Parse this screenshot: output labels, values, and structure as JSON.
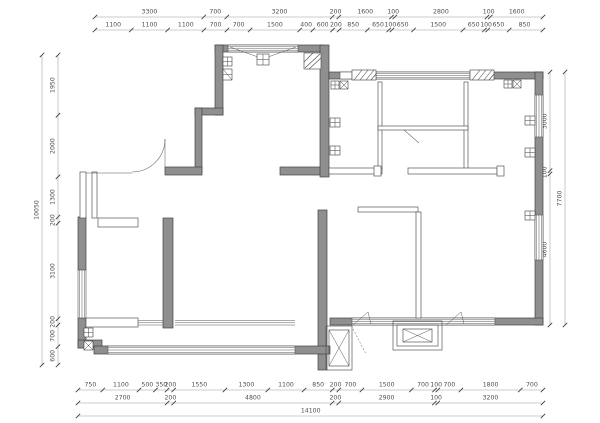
{
  "drawing": {
    "type": "floor-plan",
    "units": "mm",
    "colors": {
      "wall_fill": "#8f8f8f",
      "wall_stroke": "#434343",
      "dim_line": "#9a9a9a",
      "dim_text": "#4f4f4f",
      "background": "#ffffff"
    }
  },
  "dims": {
    "top_row1": [
      "3300",
      "700",
      "3200",
      "200",
      "1600",
      "100",
      "2800",
      "100",
      "1600"
    ],
    "top_row2": [
      "1100",
      "1100",
      "1100",
      "700",
      "700",
      "1500",
      "400",
      "600",
      "200",
      "850",
      "650",
      "100",
      "650",
      "1500",
      "650",
      "100",
      "650",
      "850"
    ],
    "bottom_row1": [
      "750",
      "1100",
      "500",
      "350",
      "200",
      "1550",
      "1300",
      "1100",
      "850",
      "200",
      "700",
      "1500",
      "700",
      "100",
      "700",
      "1800",
      "700"
    ],
    "bottom_row2": [
      "2700",
      "200",
      "4800",
      "200",
      "2900",
      "100",
      "3200"
    ],
    "bottom_total": "14100",
    "left_col": [
      "1950",
      "2000",
      "1300",
      "200",
      "3100",
      "200",
      "700",
      "600"
    ],
    "left_total": "10050",
    "right_col": [
      "3000",
      "100",
      "4600"
    ],
    "right_total": "7700"
  }
}
